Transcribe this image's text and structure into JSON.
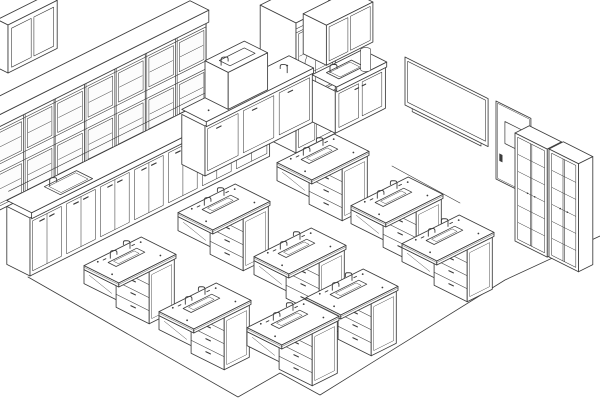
{
  "meta": {
    "title": "Science laboratory classroom — isometric line drawing",
    "description": "Black-and-white isometric technical drawing of a school science lab: wall cabinet runs, counters with sinks, teacher demo station, whiteboard, entry door, tall storage cabinets and nine student lab tables with sinks, faucets and drawer pedestals."
  },
  "canvas": {
    "width": 600,
    "height": 404
  },
  "palette": {
    "background": "#ffffff",
    "line": "#3c3c3c",
    "fill": "#ffffff",
    "glass": "#fcfcfc"
  },
  "floor": {
    "outline": [
      [
        28,
        277
      ],
      [
        238,
        397
      ],
      [
        280,
        373
      ],
      [
        320,
        395
      ],
      [
        505,
        280
      ],
      [
        600,
        236
      ]
    ],
    "wall_base_line": [
      [
        392,
        166
      ],
      [
        460,
        203
      ]
    ]
  },
  "counts": {
    "student_tables": 9,
    "upper_wall_cabinet_units": 7,
    "storage_cabinet_units": 2,
    "sinks_visible": 4
  },
  "furniture": [
    {
      "type": "floatcab",
      "name": "corner-wall-cabinet",
      "p": {
        "anchor": [
          8,
          73
        ],
        "len": 55,
        "depth": 12,
        "height": 48
      }
    },
    {
      "type": "upperrow",
      "name": "wall-cabinet-upper-row",
      "p": {
        "anchor": [
          30,
          276
        ],
        "front_v": -8,
        "back_v": -26,
        "cornice_v": -5,
        "s0": -33,
        "s1": 205,
        "stiles": [
          -33,
          1,
          35,
          69,
          103,
          137,
          171,
          205
        ],
        "rails": {
          "bottom": 74,
          "g1a": 78,
          "g1b": 112,
          "g2a": 120,
          "g2b": 154,
          "top": 160,
          "cornice": 172
        }
      }
    },
    {
      "type": "baserun",
      "name": "left-wall-counter-run",
      "p": {
        "anchor": [
          30,
          276
        ],
        "s0": 0,
        "s1": 268,
        "back_v": -26,
        "h_body": 58,
        "h_counter": 64,
        "overhang": 1.8,
        "divisions": [
          38,
          76,
          114,
          152,
          190,
          228
        ],
        "door_top": 54,
        "handle_h": 50,
        "splash_v": -24,
        "splash_h": 74,
        "sink": {
          "u0": 36,
          "u1": 72,
          "v0": -2,
          "v1": -20
        },
        "faucet_at": [
          40,
          -18
        ]
      }
    },
    {
      "type": "station",
      "name": "teacher-demo-station",
      "p": {
        "anchor": [
          296,
          153
        ],
        "tall": {
          "u0": 0,
          "u1": 44,
          "v0": -40,
          "h": 130
        },
        "base": {
          "u0": 44,
          "u1": 100,
          "v0": -26,
          "h": 42,
          "counter": 47
        },
        "sink": {
          "u0": 54,
          "u1": 82,
          "v0": -6,
          "v1": -20
        },
        "uppers": {
          "u0": 48,
          "u1": 100,
          "v0": -40,
          "v1": -14,
          "h0": 60,
          "h1": 100
        },
        "cylinder": {
          "u": 92,
          "v": -14,
          "h0": 36,
          "h1": 56,
          "r": 5
        }
      }
    },
    {
      "type": "bench",
      "name": "demo-bench-with-sink-unit",
      "p": {
        "anchor": [
          205,
          176
        ],
        "u1": 120,
        "back_v": -26,
        "h": 50,
        "counter": 55,
        "divisions": [
          40,
          80
        ],
        "box": {
          "u0": 26,
          "u1": 70,
          "h0": 55,
          "h1": 92
        },
        "sink": {
          "u0": 34,
          "u1": 62,
          "v0": -6,
          "v1": -18
        },
        "faucets": [
          [
            30,
            -12,
            92
          ],
          [
            100,
            -8,
            55
          ]
        ]
      }
    },
    {
      "type": "whiteboard",
      "name": "whiteboard",
      "p": {
        "anchor": [
          405,
          105
        ],
        "width": 93,
        "height": 48,
        "inset": 3,
        "tray": [
          8,
          85
        ]
      }
    },
    {
      "type": "wallline",
      "name": "wall-base-line",
      "p": {}
    },
    {
      "type": "door",
      "name": "entry-door",
      "p": {
        "anchor": [
          496,
          179
        ],
        "width": 39,
        "height": 78,
        "panel": {
          "v0": 10,
          "v1": 31,
          "h0": 40,
          "h1": 62
        },
        "handle": {
          "v": 4,
          "h": 20
        }
      }
    },
    {
      "type": "floorpath",
      "name": "floor-outline",
      "p": {}
    },
    {
      "type": "cubby",
      "name": "storage-cabinet-left",
      "p": {
        "anchor": [
          515,
          241
        ],
        "width": 36,
        "height": 108,
        "depth": 16,
        "shelves": 5
      }
    },
    {
      "type": "cubby",
      "name": "storage-cabinet-right",
      "p": {
        "anchor": [
          549,
          257
        ],
        "width": 33,
        "height": 108,
        "depth": 16,
        "shelves": 5
      }
    },
    {
      "type": "tables",
      "name": "student-lab-tables",
      "p": {
        "half_u": 32,
        "half_v": 19.5,
        "slab": 4,
        "pedestal": {
          "u0": 2,
          "u1": 30,
          "v0": -17.5,
          "v1": 19.5,
          "top": 4,
          "bottom": 56,
          "drawers": 4
        },
        "skirt_depth": 18,
        "trough": {
          "cu": 1,
          "cv": -5,
          "half_u": 16,
          "half_v": 4.5
        },
        "anchors": [
          [
            323,
            157
          ],
          [
            397,
            200
          ],
          [
            448,
            238
          ],
          [
            224,
            207
          ],
          [
            300,
            251
          ],
          [
            352,
            292
          ],
          [
            130,
            260
          ],
          [
            205,
            306
          ],
          [
            293,
            322
          ]
        ]
      }
    }
  ]
}
